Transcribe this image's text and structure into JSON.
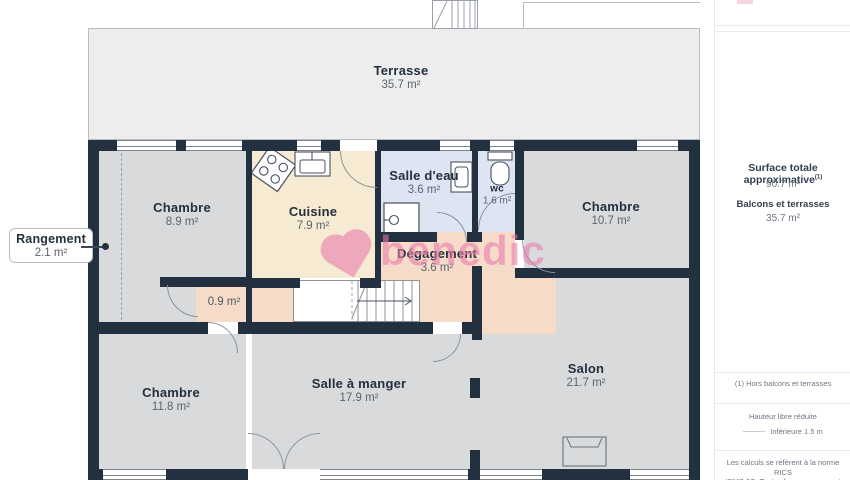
{
  "plan": {
    "watermark": "benedic",
    "rooms": {
      "terrasse": {
        "name": "Terrasse",
        "area": "35.7 m²"
      },
      "chambre1": {
        "name": "Chambre",
        "area": "8.9 m²"
      },
      "cuisine": {
        "name": "Cuisine",
        "area": "7.9 m²"
      },
      "salle_eau": {
        "name": "Salle d'eau",
        "area": "3.6 m²"
      },
      "wc": {
        "name": "wc",
        "area": "1.6 m²"
      },
      "chambre2": {
        "name": "Chambre",
        "area": "10.7 m²"
      },
      "degagement": {
        "name": "Dégagement",
        "area": "3.6 m²"
      },
      "closet": {
        "area": "0.9 m²"
      },
      "chambre3": {
        "name": "Chambre",
        "area": "11.8 m²"
      },
      "salle_a_manger": {
        "name": "Salle à manger",
        "area": "17.9 m²"
      },
      "salon": {
        "name": "Salon",
        "area": "21.7 m²"
      }
    },
    "callout": {
      "name": "Rangement",
      "area": "2.1 m²"
    }
  },
  "sidebar": {
    "surface_title": "Surface totale approximative",
    "surface_sup": "(1)",
    "surface_value": "90.7 m²",
    "balconies_title": "Balcons et terrasses",
    "balconies_value": "35.7 m²",
    "footnote": "(1) Hors balcons et terrasses",
    "legend_title": "Hauteur libre réduite",
    "legend_item": "Inférieure 1.5 m",
    "disclaimer_line1": "Les calculs se réfèrent à la norme RICS",
    "disclaimer_line2": "IPMS 3C. Toutes les mesures sont"
  }
}
